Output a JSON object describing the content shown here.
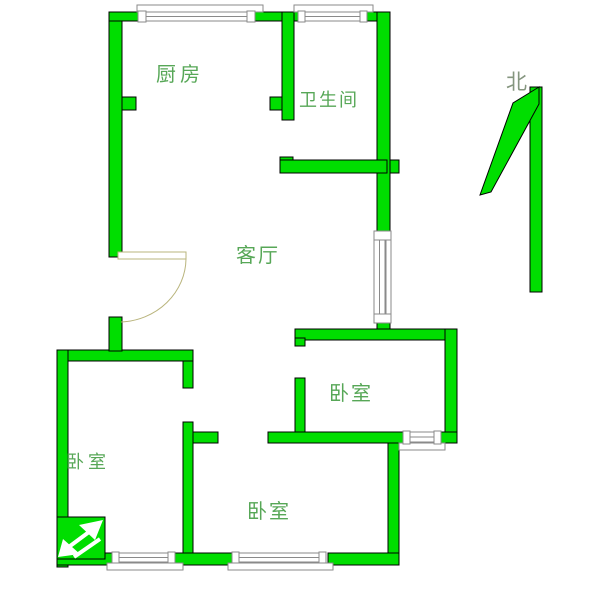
{
  "colors": {
    "wall": "#00de00",
    "label": "#57a757",
    "north_text": "#85967f",
    "window_line": "#8a8a8a",
    "door_line": "#b9b47c"
  },
  "rooms": {
    "kitchen": "厨房",
    "bathroom": "卫生间",
    "living_room": "客厅",
    "bedroom_left": "卧室",
    "bedroom_right": "卧室",
    "bedroom_bottom": "卧室"
  },
  "compass": {
    "north_label": "北"
  }
}
